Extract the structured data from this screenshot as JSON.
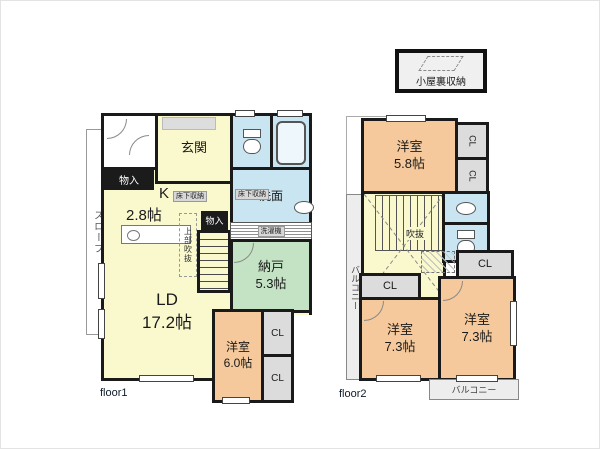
{
  "palette": {
    "wall": "#1a1a1a",
    "room_yellow": "#faf8cd",
    "room_orange": "#f5c99b",
    "room_green": "#c4e3c5",
    "room_blue": "#c9e5f1",
    "closet_gray": "#dcdcdc"
  },
  "floor1": {
    "caption": "floor1",
    "slope": "スロープ",
    "entrance": "玄関",
    "storage_hall": "物入",
    "storage_stairs": "物入",
    "kitchen": {
      "name": "K",
      "size": "2.8帖"
    },
    "underfloor_kitchen": "床下収納",
    "underfloor_washroom": "床下収納",
    "bathroom": "浴室",
    "washroom": "洗面",
    "laundry": "洗濯機",
    "void_above": "上部吹抜",
    "storeroom": {
      "name": "納戸",
      "size": "5.3帖"
    },
    "living_dining": {
      "name": "LD",
      "size": "17.2帖"
    },
    "bedroom": {
      "name": "洋室",
      "size": "6.0帖"
    },
    "closet_upper": "CL",
    "closet_lower": "CL"
  },
  "floor2": {
    "caption": "floor2",
    "attic_storage": "小屋裏収納",
    "bedroom_small": {
      "name": "洋室",
      "size": "5.8帖"
    },
    "closet_a": "CL",
    "closet_b": "CL",
    "closet_c": "CL",
    "closet_d": "CL",
    "void": "吹抜",
    "balcony_side": "バルコニー",
    "balcony_bottom": "バルコニー",
    "bedroom_left": {
      "name": "洋室",
      "size": "7.3帖"
    },
    "bedroom_right": {
      "name": "洋室",
      "size": "7.3帖"
    }
  },
  "icons": {
    "toilet_floor1": "toilet-icon",
    "toilet_floor2": "toilet-icon",
    "bathtub": "bathtub-icon",
    "washbasin_floor1": "washbasin-icon",
    "washbasin_floor2": "washbasin-icon",
    "kitchen_sink": "kitchen-sink-icon",
    "attic_ladder": "attic-ladder-icon",
    "void_cross": "void-cross-lines"
  }
}
